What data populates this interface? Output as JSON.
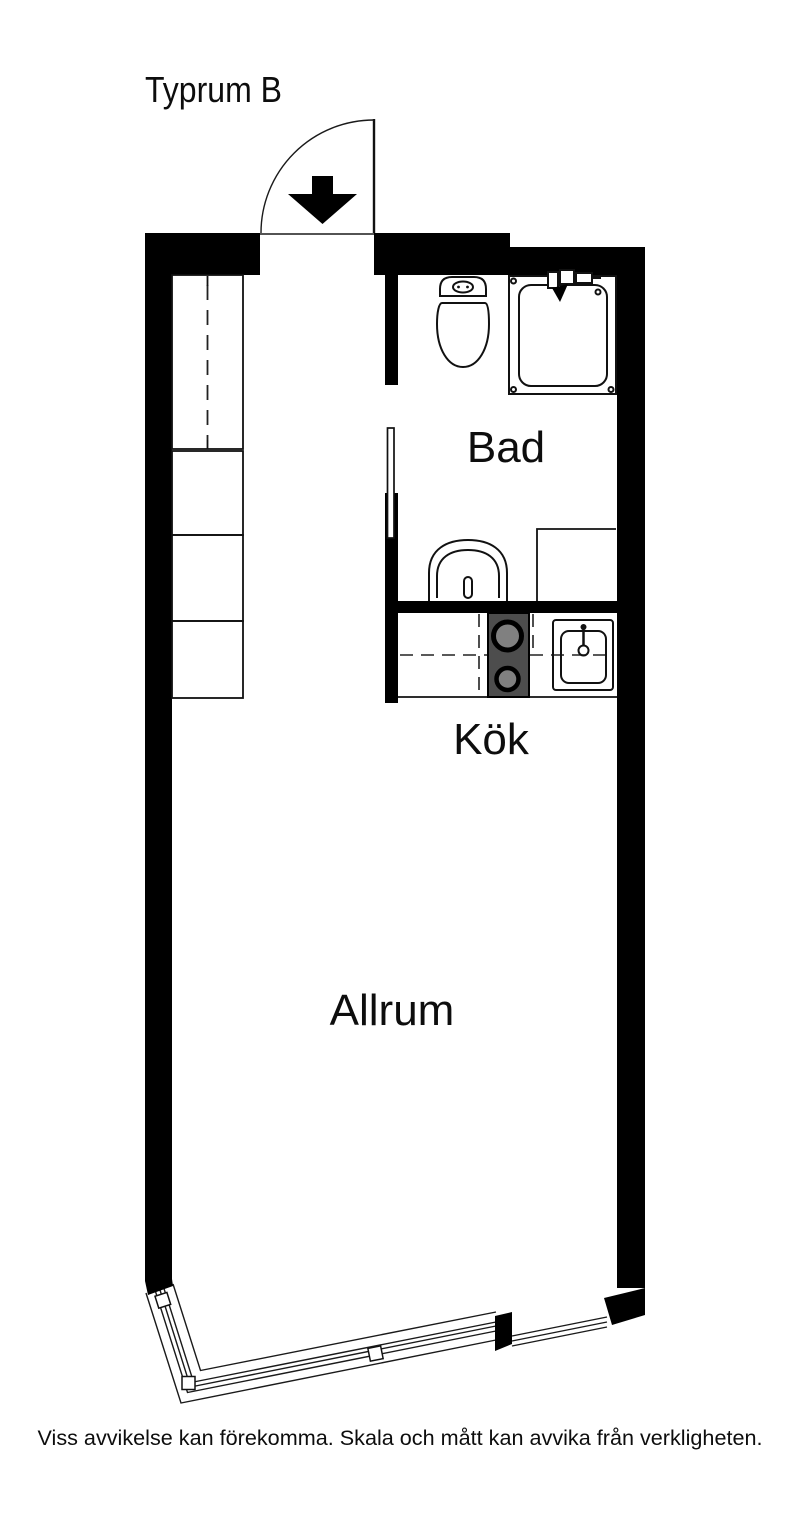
{
  "plan": {
    "title": "Typrum B",
    "rooms": [
      {
        "id": "bad",
        "label": "Bad"
      },
      {
        "id": "kok",
        "label": "Kök"
      },
      {
        "id": "allrum",
        "label": "Allrum"
      }
    ],
    "disclaimer": "Viss avvikelse kan förekomma. Skala och mått kan avvika från verkligheten.",
    "colors": {
      "walls": "#000000",
      "lines": "#1a1a1a",
      "stove": "#4d4d4d",
      "burner": "#808080",
      "background": "#ffffff"
    }
  }
}
